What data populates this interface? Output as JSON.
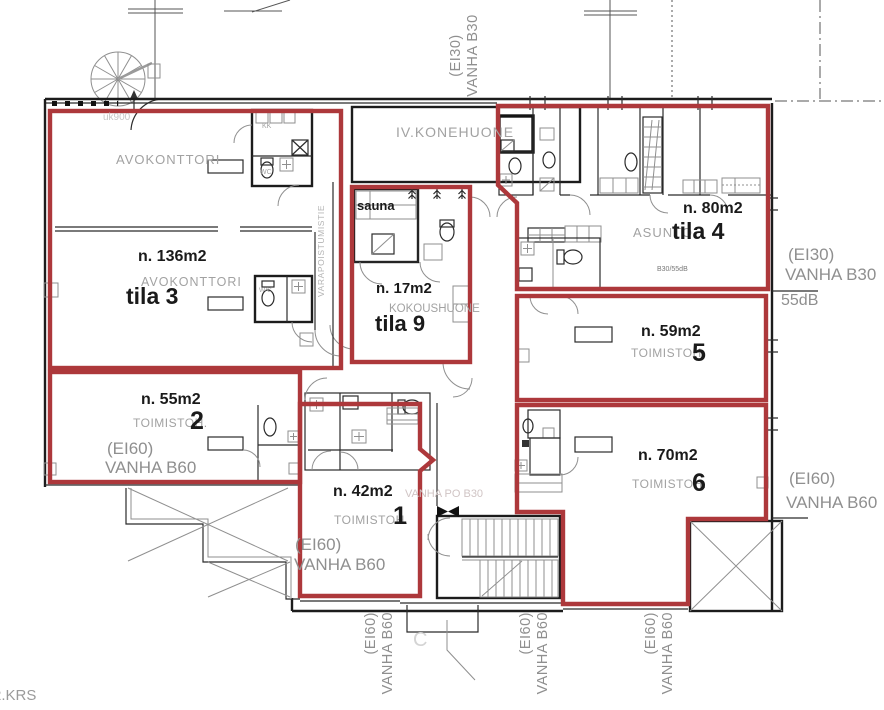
{
  "plan": {
    "floor_label": "2.KRS",
    "grid_label_c": "C",
    "spaces": {
      "avokonttori_upper": {
        "type": "AVOKONTTORI"
      },
      "tila3": {
        "area": "n. 136m2",
        "type": "AVOKONTTORI",
        "name": "tila 3"
      },
      "tila9": {
        "area": "n. 17m2",
        "type": "KOKOUSHUONE",
        "name": "tila 9"
      },
      "tila4": {
        "area": "n. 80m2",
        "type": "ASUNTO",
        "name": "tila 4",
        "note": "B30/55dB"
      },
      "room5": {
        "area": "n. 59m2",
        "type": "TOIMISTOH.",
        "number": "5"
      },
      "room2": {
        "area": "n. 55m2",
        "type": "TOIMISTOH.",
        "number": "2",
        "fire1": "(EI60)",
        "fire2": "VANHA B60"
      },
      "room1": {
        "area": "n. 42m2",
        "type": "TOIMISTOH.",
        "number": "1",
        "fire1": "(EI60)",
        "fire2": "VANHA B60"
      },
      "room6": {
        "area": "n. 70m2",
        "type": "TOIMISTOH.",
        "number": "6"
      },
      "sauna": {
        "name": "sauna"
      },
      "iv_konehuone": {
        "name": "IV.KONEHUONE"
      },
      "kk": {
        "name": "KK"
      },
      "wc_upper": {
        "name": "WC"
      },
      "wc_mid": {
        "name": "W/C"
      },
      "escape_route": {
        "name": "VARAPOISTUMISTIE"
      }
    },
    "edge_labels": {
      "top": {
        "l1": "(EI30)",
        "l2": "VANHA B30"
      },
      "right_top": {
        "l1": "(EI30)",
        "l2": "VANHA B30",
        "db": "55dB"
      },
      "right_bottom": {
        "l1": "(EI60)",
        "l2": "VANHA B60"
      },
      "bottom_left": {
        "l1": "(EI60)",
        "l2": "VANHA B60"
      },
      "bottom_mid": {
        "l1": "(EI60)",
        "l2": "VANHA B60"
      },
      "bottom_right": {
        "l1": "(EI60)",
        "l2": "VANHA B60"
      }
    },
    "faint_notes": {
      "uk900": "uk900",
      "old_door": "VANHA PO B30"
    },
    "colors": {
      "zone_outline": "#ad383b",
      "walls": "#1c1c1c",
      "room_label": "#9c9c9c",
      "area_label": "#111111"
    }
  }
}
